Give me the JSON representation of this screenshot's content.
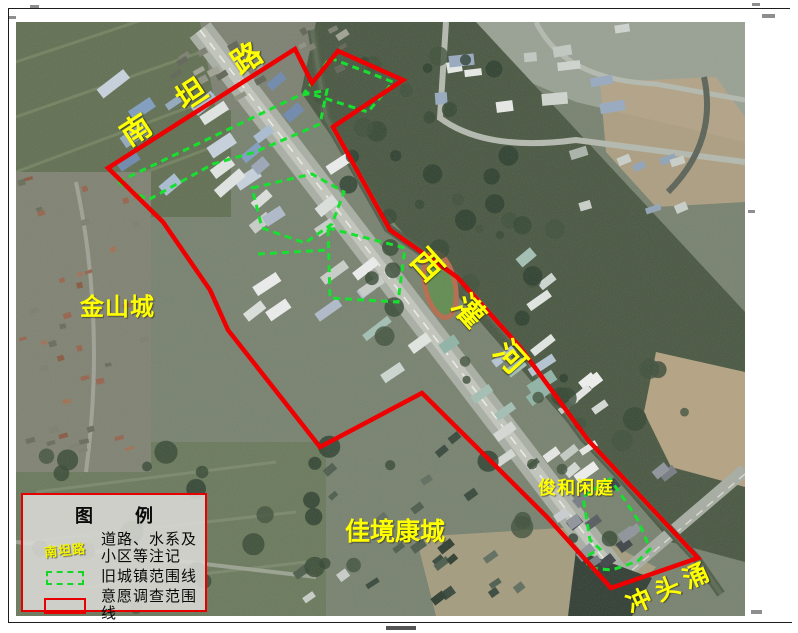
{
  "map": {
    "place_labels": [
      {
        "id": "nantan-road",
        "text": "南坦路",
        "kind": "road"
      },
      {
        "id": "jinshan-city",
        "text": "金山城",
        "kind": "district"
      },
      {
        "id": "xiguan-river",
        "text": "西灌河",
        "kind": "river"
      },
      {
        "id": "jiajing-kangcheng",
        "text": "佳境康城",
        "kind": "residential-area"
      },
      {
        "id": "junhe-xianting",
        "text": "俊和闲庭",
        "kind": "residential-area"
      },
      {
        "id": "chongtou-creek",
        "text": "冲头涌",
        "kind": "waterway"
      }
    ],
    "colors": {
      "survey_boundary": "#ee0000",
      "old_town_boundary": "#17e02e",
      "place_label": "#ffff00"
    }
  },
  "legend": {
    "title": "图　例",
    "items": [
      {
        "symbol": "yellow-road-text-sample",
        "symbol_text": "南坦路",
        "label_line1": "道路、水系及",
        "label_line2": "小区等注记"
      },
      {
        "symbol": "green-dashed-box",
        "label_line1": "旧城镇范围线",
        "label_line2": ""
      },
      {
        "symbol": "red-solid-box",
        "label_line1": "意愿调查范围线",
        "label_line2": ""
      }
    ]
  }
}
